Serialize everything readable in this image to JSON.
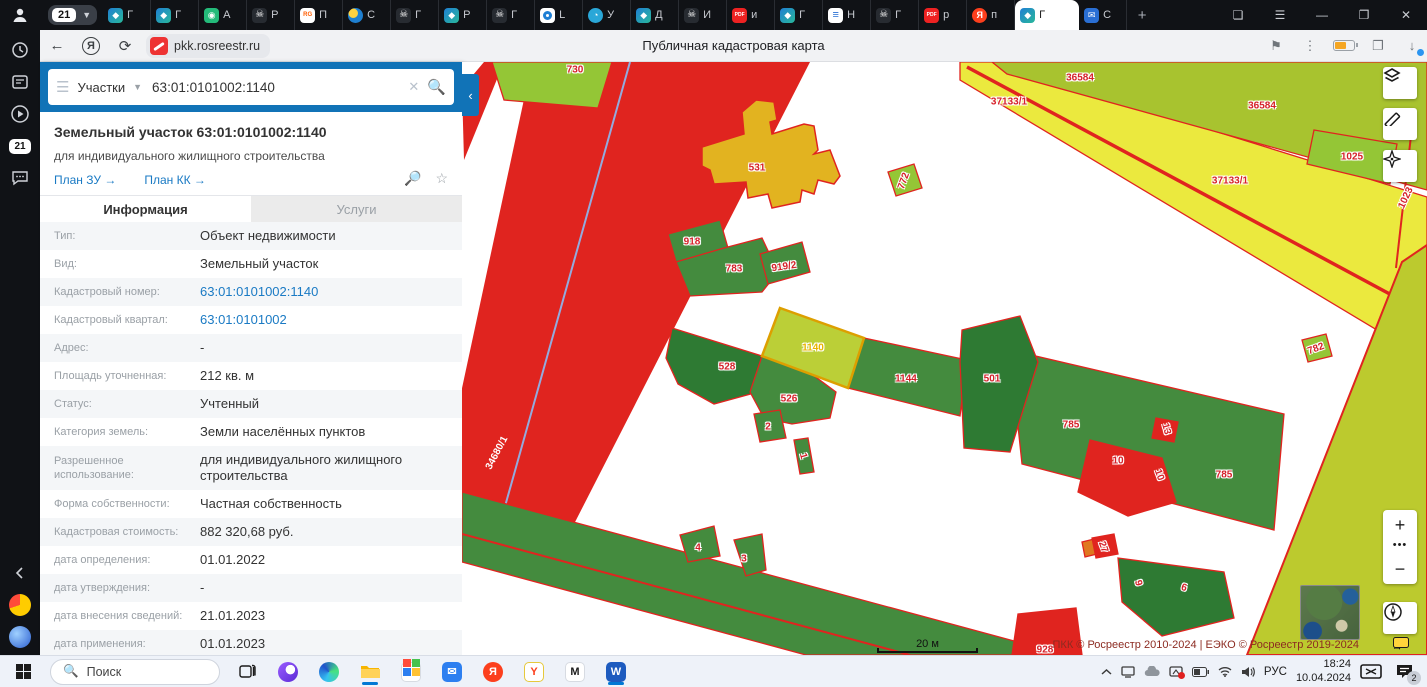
{
  "browser": {
    "tab_group_badge": "21",
    "new_tab_label": "+",
    "tabs": [
      {
        "icon": "gem",
        "title": "Г"
      },
      {
        "icon": "gem",
        "title": "Г"
      },
      {
        "icon": "robot",
        "title": "А"
      },
      {
        "icon": "skull",
        "title": "Р"
      },
      {
        "icon": "rgru",
        "title": "П"
      },
      {
        "icon": "sphere",
        "title": "С"
      },
      {
        "icon": "skull",
        "title": "Г"
      },
      {
        "icon": "gem",
        "title": "Р"
      },
      {
        "icon": "skull",
        "title": "Г"
      },
      {
        "icon": "ring",
        "title": "L"
      },
      {
        "icon": "planet",
        "title": "У"
      },
      {
        "icon": "gem",
        "title": "Д"
      },
      {
        "icon": "skull",
        "title": "И"
      },
      {
        "icon": "pdf",
        "title": "и"
      },
      {
        "icon": "gem",
        "title": "Г"
      },
      {
        "icon": "lines",
        "title": "Н"
      },
      {
        "icon": "skull",
        "title": "Г"
      },
      {
        "icon": "pdf",
        "title": "р"
      },
      {
        "icon": "ya",
        "title": "п"
      },
      {
        "icon": "gem",
        "title": "Г",
        "active": true
      },
      {
        "icon": "mail",
        "title": "С"
      }
    ],
    "toolbar": {
      "url": "pkk.rosreestr.ru",
      "page_title": "Публичная кадастровая карта"
    }
  },
  "panel": {
    "search": {
      "category": "Участки",
      "query": "63:01:0101002:1140"
    },
    "title": "Земельный участок 63:01:0101002:1140",
    "subtitle": "для индивидуального жилищного строительства",
    "links": [
      {
        "label": "План ЗУ"
      },
      {
        "label": "План КК"
      }
    ],
    "tabs": {
      "info": "Информация",
      "services": "Услуги"
    },
    "rows": [
      {
        "label": "Тип:",
        "value": "Объект недвижимости"
      },
      {
        "label": "Вид:",
        "value": "Земельный участок"
      },
      {
        "label": "Кадастровый номер:",
        "value": "63:01:0101002:1140",
        "link": true
      },
      {
        "label": "Кадастровый квартал:",
        "value": "63:01:0101002",
        "link": true
      },
      {
        "label": "Адрес:",
        "value": "-"
      },
      {
        "label": "Площадь уточненная:",
        "value": "212 кв. м"
      },
      {
        "label": "Статус:",
        "value": "Учтенный"
      },
      {
        "label": "Категория земель:",
        "value": "Земли населённых пунктов"
      },
      {
        "label": "Разрешенное использование:",
        "value": "для индивидуального жилищного строительства",
        "tall": true
      },
      {
        "label": "Форма собственности:",
        "value": "Частная собственность"
      },
      {
        "label": "Кадастровая стоимость:",
        "value": "882 320,68 руб."
      },
      {
        "label": "дата определения:",
        "value": "01.01.2022"
      },
      {
        "label": "дата утверждения:",
        "value": "-"
      },
      {
        "label": "дата внесения сведений:",
        "value": "21.01.2023"
      },
      {
        "label": "дата применения:",
        "value": "01.01.2023"
      }
    ]
  },
  "map": {
    "selected_parcel": "1140",
    "parcel_labels": [
      {
        "text": "730",
        "x": 113,
        "y": 8
      },
      {
        "text": "36584",
        "x": 618,
        "y": 16
      },
      {
        "text": "37133/1",
        "x": 547,
        "y": 40
      },
      {
        "text": "36584",
        "x": 800,
        "y": 44
      },
      {
        "text": "1025",
        "x": 890,
        "y": 95
      },
      {
        "text": "37133/1",
        "x": 768,
        "y": 119
      },
      {
        "text": "1023",
        "x": 944,
        "y": 136,
        "rot": -65
      },
      {
        "text": "531",
        "x": 295,
        "y": 106
      },
      {
        "text": "772",
        "x": 442,
        "y": 119,
        "rot": -70
      },
      {
        "text": "918",
        "x": 230,
        "y": 180
      },
      {
        "text": "783",
        "x": 272,
        "y": 207
      },
      {
        "text": "919/2",
        "x": 322,
        "y": 205,
        "rot": -8
      },
      {
        "text": "1140",
        "x": 351,
        "y": 286,
        "style": "sel"
      },
      {
        "text": "528",
        "x": 265,
        "y": 305
      },
      {
        "text": "526",
        "x": 327,
        "y": 337
      },
      {
        "text": "1144",
        "x": 444,
        "y": 317
      },
      {
        "text": "501",
        "x": 530,
        "y": 317
      },
      {
        "text": "2",
        "x": 306,
        "y": 365
      },
      {
        "text": "1",
        "x": 341,
        "y": 394,
        "rot": 75
      },
      {
        "text": "785",
        "x": 609,
        "y": 363
      },
      {
        "text": "13",
        "x": 704,
        "y": 367,
        "rot": 75
      },
      {
        "text": "10",
        "x": 656,
        "y": 399
      },
      {
        "text": "10",
        "x": 697,
        "y": 413,
        "rot": 70
      },
      {
        "text": "785",
        "x": 762,
        "y": 413
      },
      {
        "text": "782",
        "x": 854,
        "y": 287,
        "rot": -20
      },
      {
        "text": "34680/1",
        "x": 35,
        "y": 391,
        "rot": -62,
        "style": "wht"
      },
      {
        "text": "4",
        "x": 236,
        "y": 486
      },
      {
        "text": "3",
        "x": 282,
        "y": 497
      },
      {
        "text": "27",
        "x": 641,
        "y": 485,
        "rot": 70
      },
      {
        "text": "9",
        "x": 676,
        "y": 521,
        "rot": 75
      },
      {
        "text": "6",
        "x": 722,
        "y": 526,
        "rot": 15
      },
      {
        "text": "928",
        "x": 583,
        "y": 588
      }
    ],
    "controls": {
      "zoom_in": "+",
      "zoom_out": "−",
      "more": "•••",
      "collapse": "‹"
    },
    "scale_label": "20 м",
    "attribution": "ПКК © Росреестр 2010-2024 | ЕЭКО © Росреестр 2019-2024"
  },
  "taskbar": {
    "search_placeholder": "Поиск",
    "apps": [
      "task-view",
      "alice",
      "edge",
      "explorer",
      "store",
      "mail",
      "yandex",
      "y-services",
      "miro",
      "word"
    ],
    "tray": {
      "language": "РУС",
      "time": "18:24",
      "date": "10.04.2024",
      "notification_badge": "2"
    }
  }
}
